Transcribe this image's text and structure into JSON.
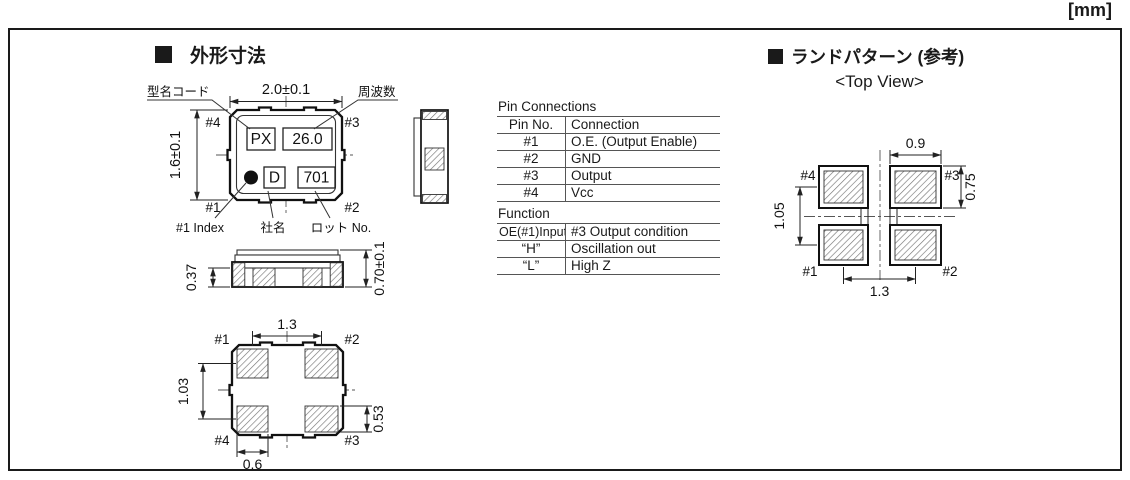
{
  "page": {
    "unit_label": "[mm]"
  },
  "outline_section": {
    "title": "外形寸法",
    "top_view": {
      "dim_width": "2.0±0.1",
      "dim_height": "1.6±0.1",
      "callout_model_code": "型名コード",
      "callout_frequency": "周波数",
      "callout_index": "#1 Index",
      "callout_company": "社名",
      "callout_lot": "ロット No.",
      "marking_model": "PX",
      "marking_frequency": "26.0",
      "marking_company": "D",
      "marking_lot": "701",
      "pins": {
        "p1": "#1",
        "p2": "#2",
        "p3": "#3",
        "p4": "#4"
      }
    },
    "front_view": {
      "dim_pad_height": "0.37",
      "dim_total_height": "0.70±0.1"
    },
    "bottom_view": {
      "dim_pitch_x": "1.3",
      "dim_pitch_y": "1.03",
      "dim_pad_height": "0.53",
      "dim_pad_width": "0.6",
      "pins": {
        "p1": "#1",
        "p2": "#2",
        "p3": "#3",
        "p4": "#4"
      }
    }
  },
  "land_section": {
    "title": "ランドパターン (参考)",
    "subtitle": "<Top View>",
    "view": {
      "dim_pad_width": "0.9",
      "dim_pad_height": "0.75",
      "dim_pitch_y": "1.05",
      "dim_pitch_x": "1.3",
      "pins": {
        "p1": "#1",
        "p2": "#2",
        "p3": "#3",
        "p4": "#4"
      }
    }
  },
  "pin_connections": {
    "title": "Pin Connections",
    "headers": [
      "Pin No.",
      "Connection"
    ],
    "rows": [
      [
        "#1",
        "O.E. (Output Enable)"
      ],
      [
        "#2",
        "GND"
      ],
      [
        "#3",
        "Output"
      ],
      [
        "#4",
        "Vcc"
      ]
    ]
  },
  "function_table": {
    "title": "Function",
    "headers": [
      "OE(#1)Input",
      "#3 Output condition"
    ],
    "rows": [
      [
        "“H”",
        "Oscillation out"
      ],
      [
        "“L”",
        "High Z"
      ]
    ]
  }
}
